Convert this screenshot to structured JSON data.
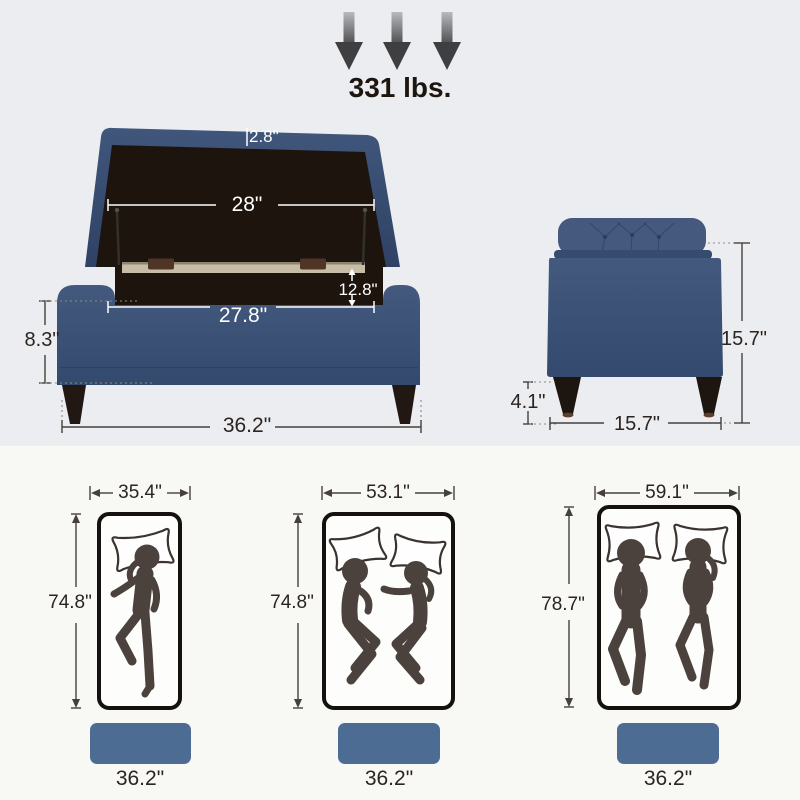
{
  "colors": {
    "top_background": "#ebedf0",
    "bottom_background": "#f8f8f5",
    "fabric_navy": "#3c5174",
    "footprint_blue": "#4d6c94",
    "figure_brown": "#4b423d",
    "dim_text_dark": "#2c241f",
    "dim_text_light": "#ffffff"
  },
  "weight_capacity": {
    "label": "331 lbs."
  },
  "front_view": {
    "lid_thickness": "2.8\"",
    "lid_width": "28\"",
    "interior_depth": "12.8\"",
    "interior_width": "27.8\"",
    "base_height": "8.3\"",
    "overall_width": "36.2\""
  },
  "side_view": {
    "overall_height": "15.7\"",
    "leg_height": "4.1\"",
    "overall_depth": "15.7\""
  },
  "mattress_comparison": [
    {
      "sleepers": 1,
      "width": "35.4\"",
      "length": "74.8\"",
      "ottoman_width": "36.2\""
    },
    {
      "sleepers": 2,
      "width": "53.1\"",
      "length": "74.8\"",
      "ottoman_width": "36.2\""
    },
    {
      "sleepers": 2,
      "width": "59.1\"",
      "length": "78.7\"",
      "ottoman_width": "36.2\""
    }
  ]
}
